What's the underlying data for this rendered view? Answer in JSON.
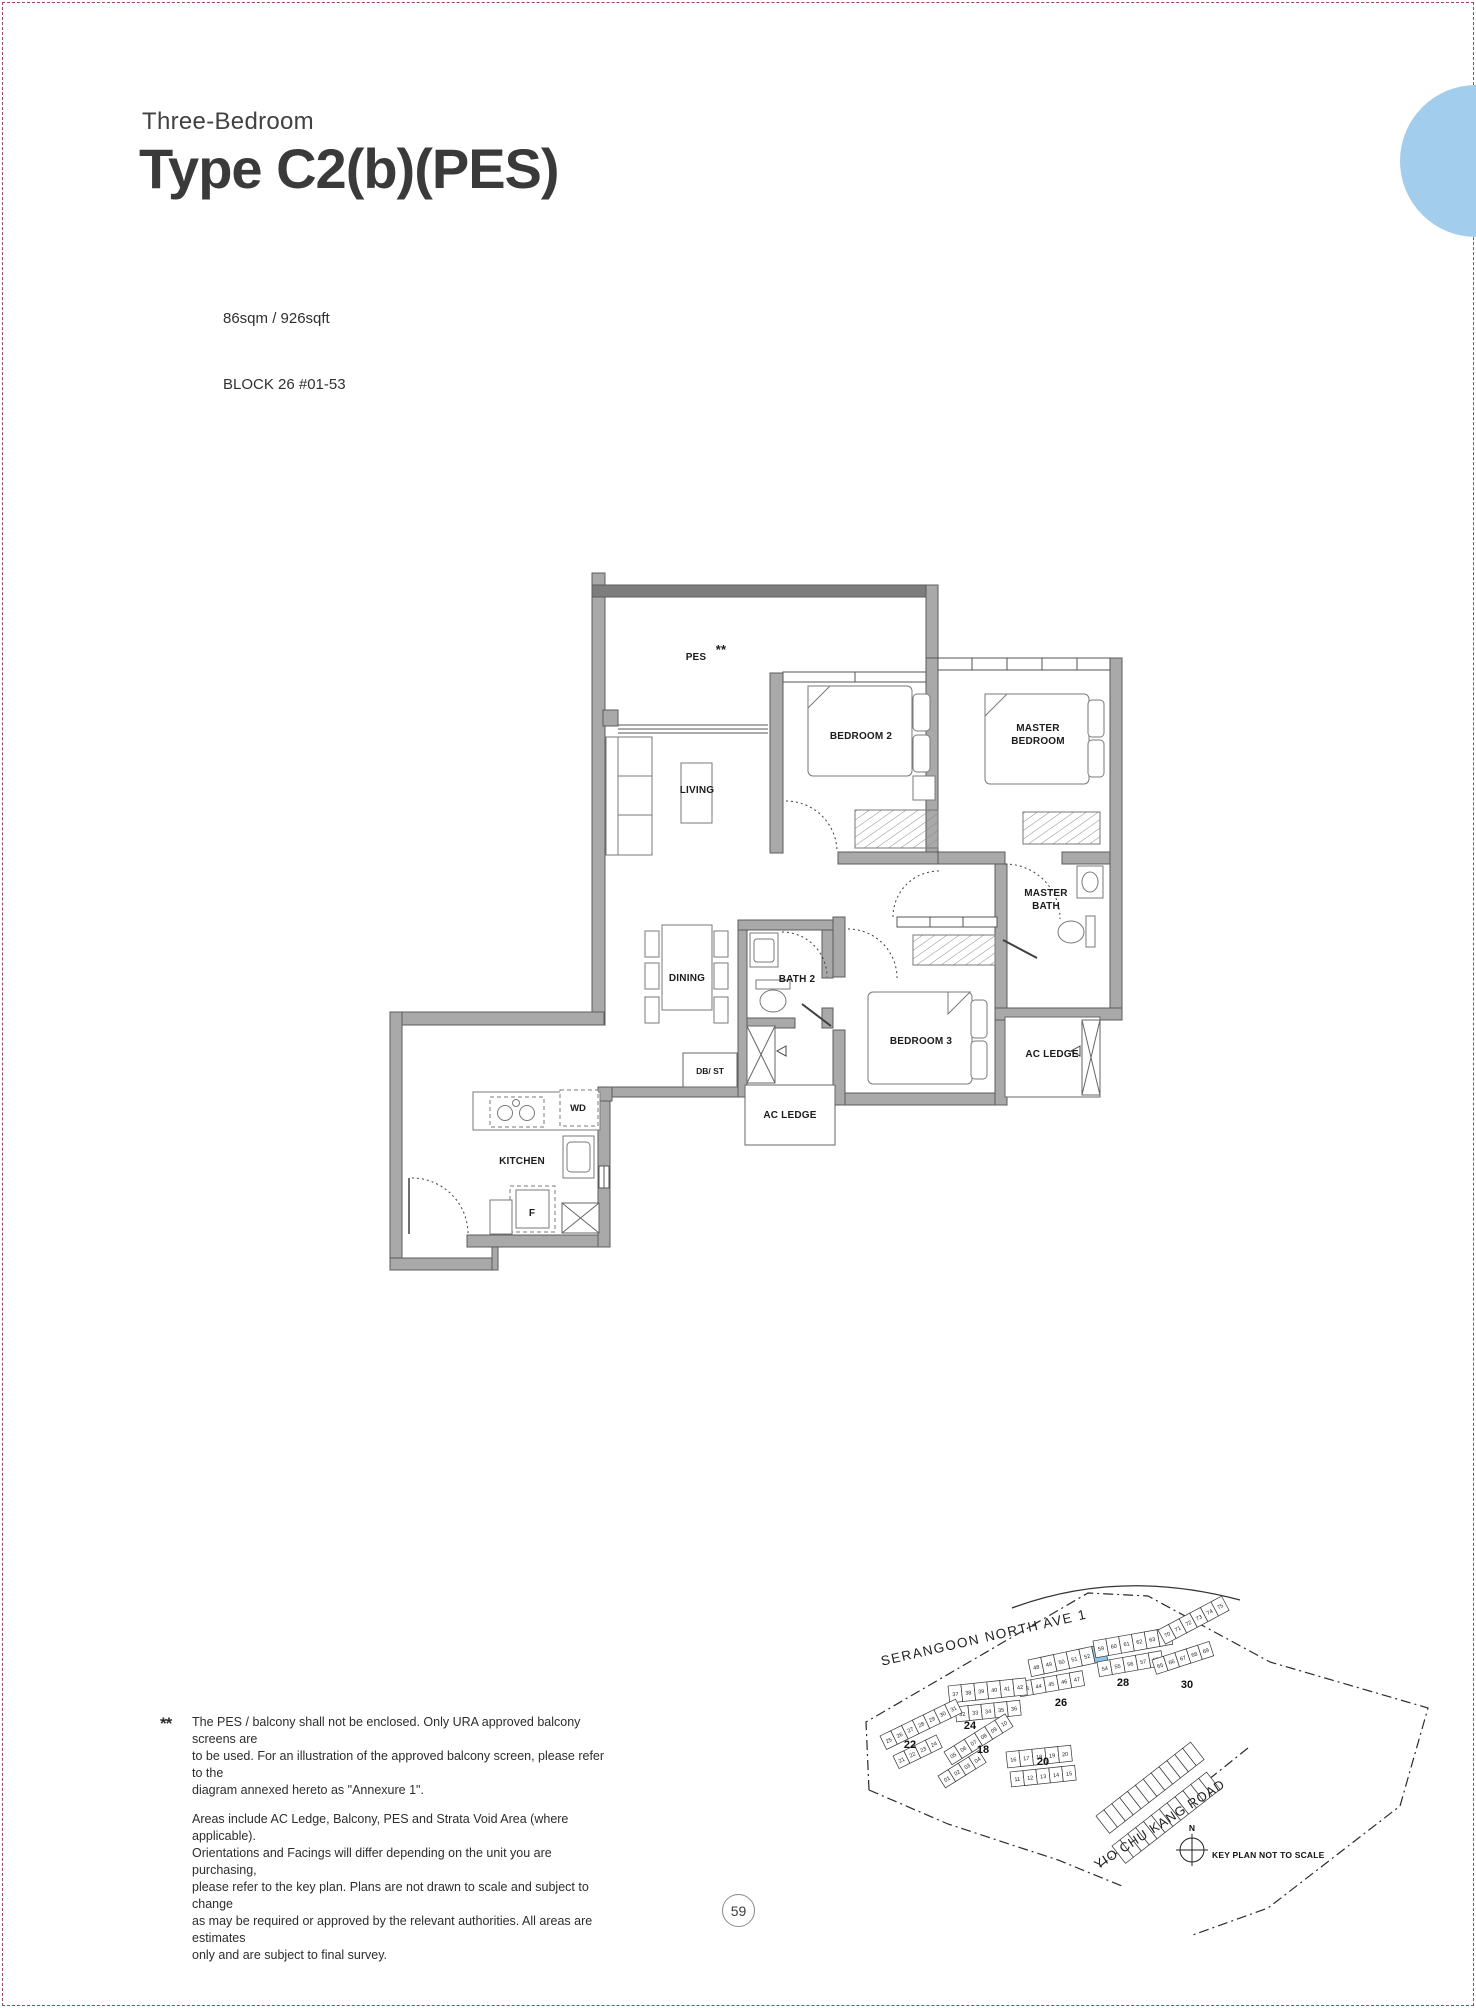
{
  "page": {
    "number": "59"
  },
  "header": {
    "kicker": "Three-Bedroom",
    "title": "Type C2(b)(PES)",
    "area": "86sqm / 926sqft",
    "block": "BLOCK 26 #01-53"
  },
  "footnote": {
    "marker": "**",
    "para1": "The PES / balcony shall not be enclosed. Only URA approved balcony screens are\nto be used. For an illustration of the approved balcony screen, please refer to the\ndiagram annexed hereto as \"Annexure 1\".",
    "para2": "Areas include AC Ledge, Balcony, PES and Strata Void Area (where applicable).\nOrientations and Facings will differ depending on the unit you are purchasing,\nplease refer to the key plan. Plans are not drawn to scale and subject to change\nas may be required or approved by the relevant authorities. All areas are estimates\nonly and are subject to final survey."
  },
  "plan": {
    "rooms": {
      "pes": "PES",
      "pes_note": "**",
      "living": "LIVING",
      "dining": "DINING",
      "kitchen": "KITCHEN",
      "bath2": "BATH 2",
      "bedroom2": "BEDROOM 2",
      "master_line1": "MASTER",
      "master_line2": "BEDROOM",
      "masterbath_line1": "MASTER",
      "masterbath_line2": "BATH",
      "bedroom3": "BEDROOM 3",
      "ac_ledge_right": "AC LEDGE",
      "ac_ledge_bottom": "AC LEDGE",
      "db_st": "DB/ ST",
      "wd": "WD",
      "fridge": "F"
    }
  },
  "keyplan": {
    "street_top": "SERANGOON NORTH AVE 1",
    "street_bottom": "YIO CHU KANG ROAD",
    "north": "N",
    "note": "KEY PLAN NOT TO SCALE",
    "highlight_unit": "53",
    "highlight_block": "26",
    "highlight_color": "#8ec4e8",
    "blocks": [
      {
        "no": "22"
      },
      {
        "no": "24"
      },
      {
        "no": "26"
      },
      {
        "no": "28"
      },
      {
        "no": "30"
      },
      {
        "no": "18"
      },
      {
        "no": "20"
      }
    ],
    "unit_rows": [
      {
        "block": "26",
        "units": [
          "48",
          "49",
          "50",
          "51",
          "52",
          "53"
        ]
      },
      {
        "block": "26",
        "units": [
          "43",
          "44",
          "45",
          "46",
          "47"
        ]
      },
      {
        "block": "28",
        "units": [
          "59",
          "60",
          "61",
          "62",
          "63",
          "64"
        ]
      },
      {
        "block": "28",
        "units": [
          "54",
          "55",
          "56",
          "57",
          "58"
        ]
      },
      {
        "block": "30",
        "units": [
          "70",
          "71",
          "72",
          "73",
          "74",
          "75"
        ]
      },
      {
        "block": "30",
        "units": [
          "65",
          "66",
          "67",
          "68",
          "69"
        ]
      },
      {
        "block": "24",
        "units": [
          "37",
          "38",
          "39",
          "40",
          "41",
          "42"
        ]
      },
      {
        "block": "24",
        "units": [
          "32",
          "33",
          "34",
          "35",
          "36"
        ]
      },
      {
        "block": "22",
        "units": [
          "25",
          "26",
          "27",
          "28",
          "29",
          "30",
          "31"
        ]
      },
      {
        "block": "22",
        "units": [
          "21",
          "22",
          "23",
          "24"
        ]
      },
      {
        "block": "18",
        "units": [
          "05",
          "06",
          "07",
          "08",
          "09",
          "10"
        ]
      },
      {
        "block": "18",
        "units": [
          "01",
          "02",
          "03",
          "04"
        ]
      },
      {
        "block": "20",
        "units": [
          "16",
          "17",
          "18",
          "19",
          "20"
        ]
      },
      {
        "block": "20",
        "units": [
          "11",
          "12",
          "13",
          "14",
          "15"
        ]
      }
    ]
  }
}
